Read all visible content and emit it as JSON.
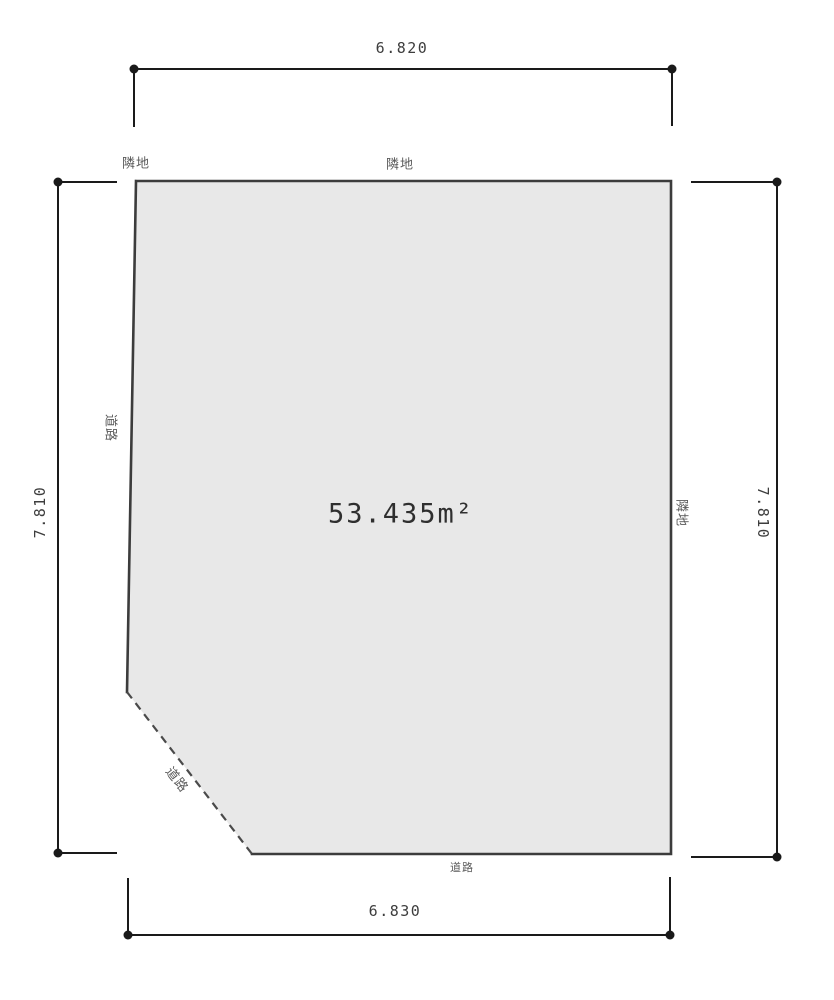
{
  "diagram": {
    "title": "land-plot-survey-diagram",
    "area_label": "53.435m²",
    "dimensions": {
      "top": "6.820",
      "bottom": "6.830",
      "left": "7.810",
      "right": "7.810"
    },
    "labels": {
      "top_left": "隣地",
      "top_center": "隣地",
      "left_side": "道路",
      "right_side": "隣地",
      "diagonal": "道路",
      "bottom": "道路"
    },
    "colors": {
      "background": "#ffffff",
      "plot_fill": "#e8e8e8",
      "plot_border": "#3c3c3c",
      "dimension_line": "#1a1a1a",
      "label_text": "#5a5a5a",
      "dimension_text": "#3d3d3d",
      "area_text": "#2f2f2f"
    }
  }
}
